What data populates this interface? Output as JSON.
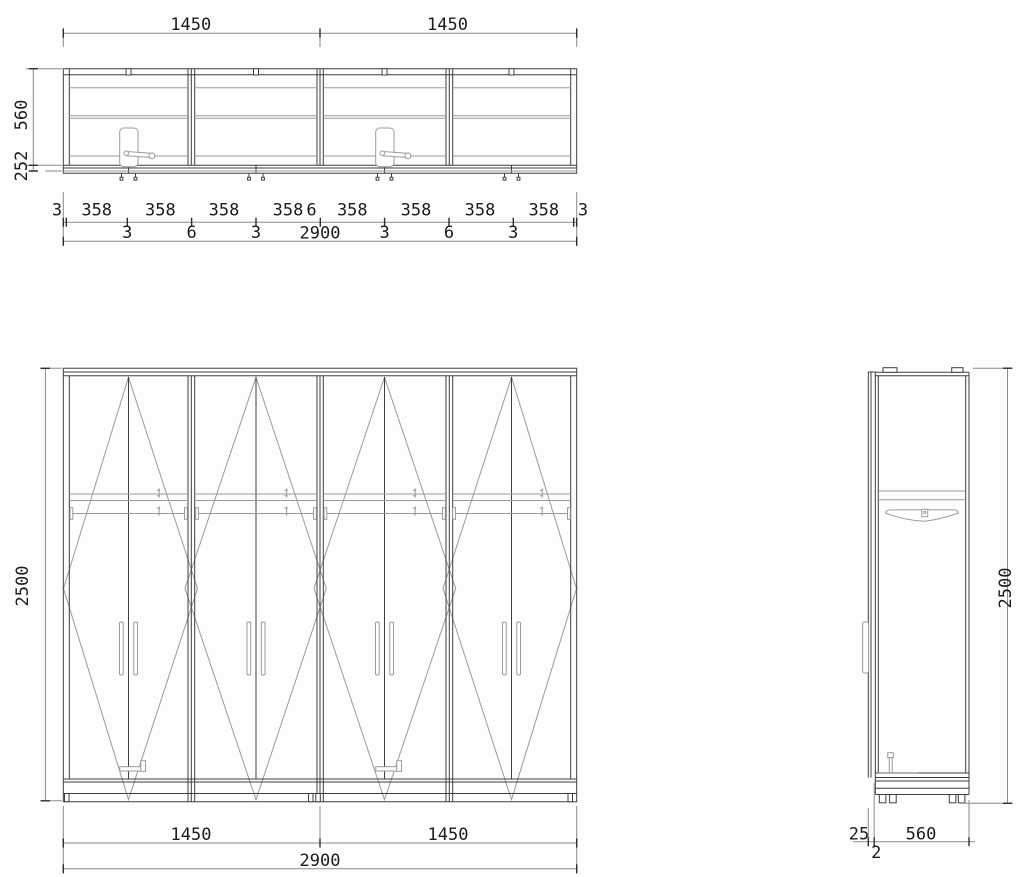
{
  "top_view": {
    "top_widths": [
      "1450",
      "1450"
    ],
    "chain_segments": [
      "3",
      "358",
      "358",
      "358",
      "358",
      "6",
      "358",
      "358",
      "358",
      "358",
      "3"
    ],
    "chain_gaps": [
      "3",
      "6",
      "3",
      "3",
      "6",
      "3"
    ],
    "total_width": "2900",
    "depth": "560",
    "front_depth": "252"
  },
  "front_view": {
    "height": "2500",
    "widths": [
      "1450",
      "1450"
    ],
    "total_width": "2900"
  },
  "side_view": {
    "height": "2500",
    "door_thickness": "25",
    "depth": "560",
    "gap": "2"
  }
}
